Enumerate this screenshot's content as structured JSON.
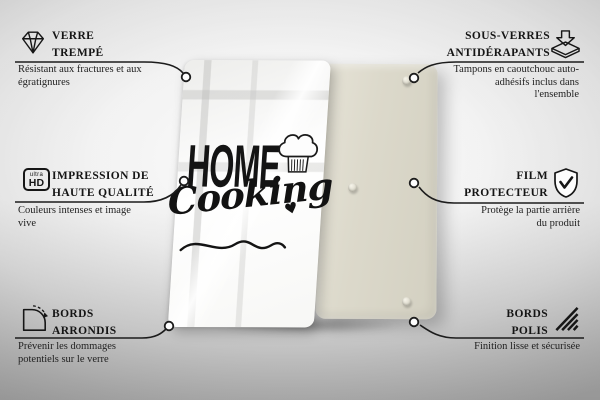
{
  "product": {
    "front_panel": {
      "design_word1": "HOME",
      "design_word2": "Cooking",
      "heart_glyph": "♥",
      "panel_color": "#ffffff"
    },
    "back_panel": {
      "panel_color": "#dcd9cb",
      "visible_rubber_pads": 3
    }
  },
  "features_left": [
    {
      "icon": "diamond-icon",
      "title": "VERRE TREMPÉ",
      "description": "Résistant aux fractures et aux égratignures"
    },
    {
      "icon": "ultra-hd-icon",
      "title": "IMPRESSION DE HAUTE QUALITÉ",
      "description": "Couleurs intenses et image vive"
    },
    {
      "icon": "rounded-corner-icon",
      "title": "BORDS ARRONDIS",
      "description": "Prévenir les dommages potentiels sur le verre"
    }
  ],
  "features_right": [
    {
      "icon": "non-slip-coaster-icon",
      "title": "SOUS-VERRES ANTIDÉRAPANTS",
      "description": "Tampons en caoutchouc auto-adhésifs inclus dans l'ensemble"
    },
    {
      "icon": "shield-check-icon",
      "title": "FILM PROTECTEUR",
      "description": "Protège la partie arrière du produit"
    },
    {
      "icon": "polished-edge-icon",
      "title": "BORDS POLIS",
      "description": "Finition lisse et sécurisée"
    }
  ],
  "icon_labels": {
    "ultra": "ultra",
    "hd": "HD"
  },
  "colors": {
    "line": "#1c1c1c",
    "text": "#151515",
    "back_panel": "#dcd9cb",
    "background_edge": "#b0b0b0"
  }
}
